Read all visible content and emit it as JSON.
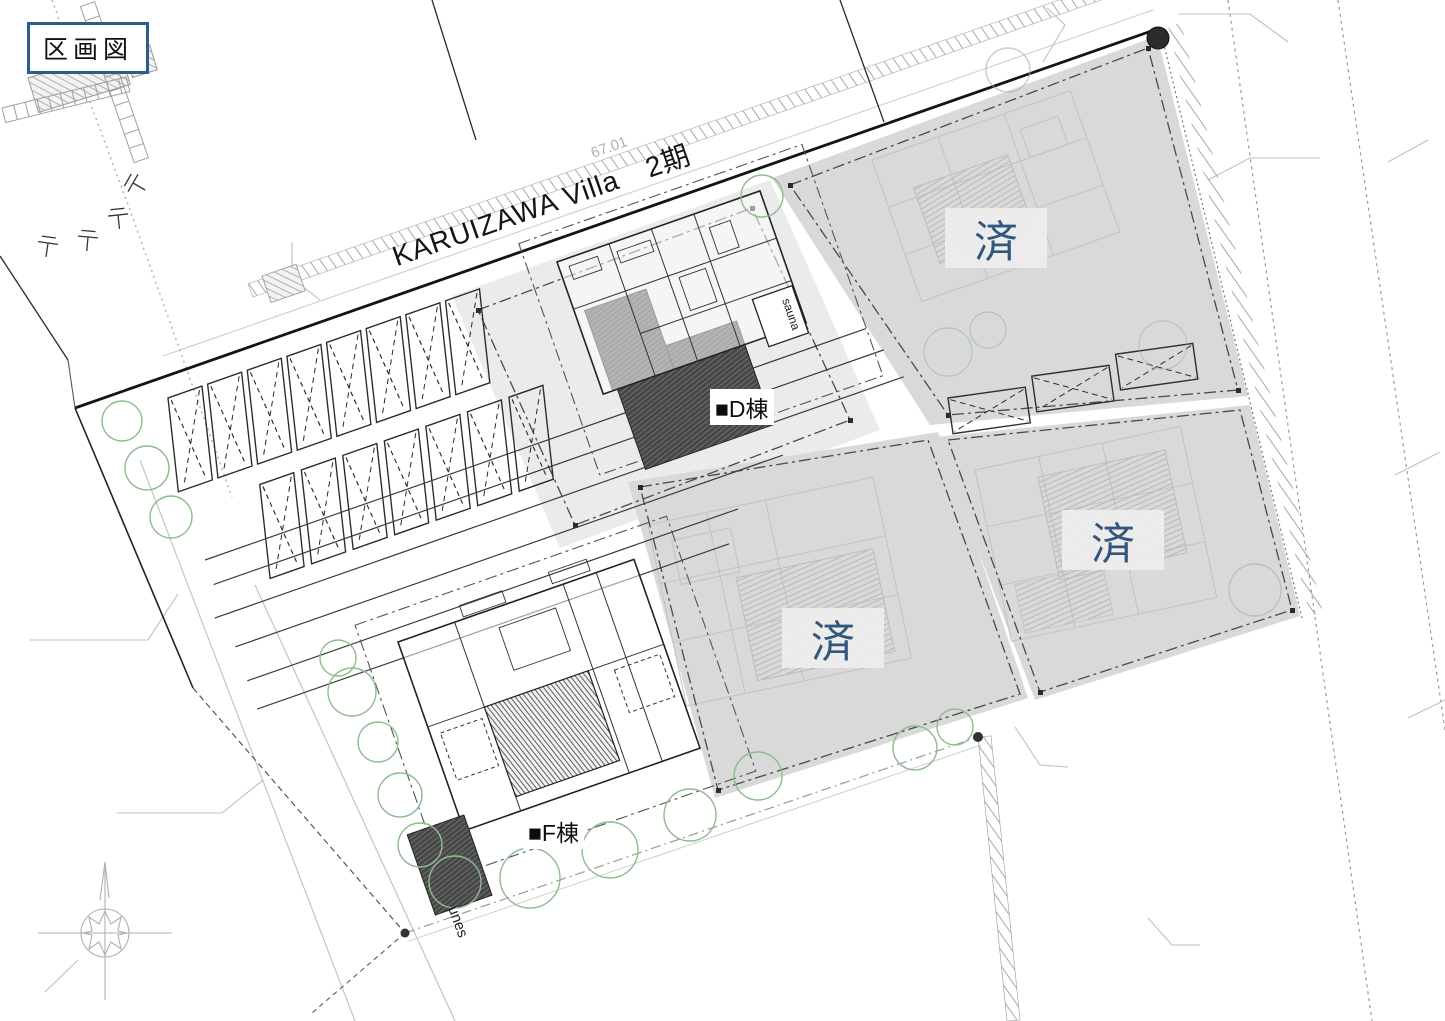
{
  "frame": {
    "title": "区画図"
  },
  "road": {
    "name": "KARUIZAWA Villa",
    "phase": "2期",
    "dimension": "67.01"
  },
  "buildings": {
    "d": {
      "label": "■D棟",
      "sauna_note": "sauna"
    },
    "f": {
      "label": "■F棟",
      "note": "unes"
    }
  },
  "lots": {
    "sold_label": "済",
    "sold_count": 3
  },
  "colors": {
    "frame_border": "#2d5d8e",
    "sold_text": "#33567d",
    "tree_green": "#8fbc8f",
    "parcel_fill_available": "#ebebeb",
    "parcel_fill_sold": "#d9d9d9",
    "line_dark": "#1a1a1a",
    "line_light": "#c4c4c4"
  }
}
